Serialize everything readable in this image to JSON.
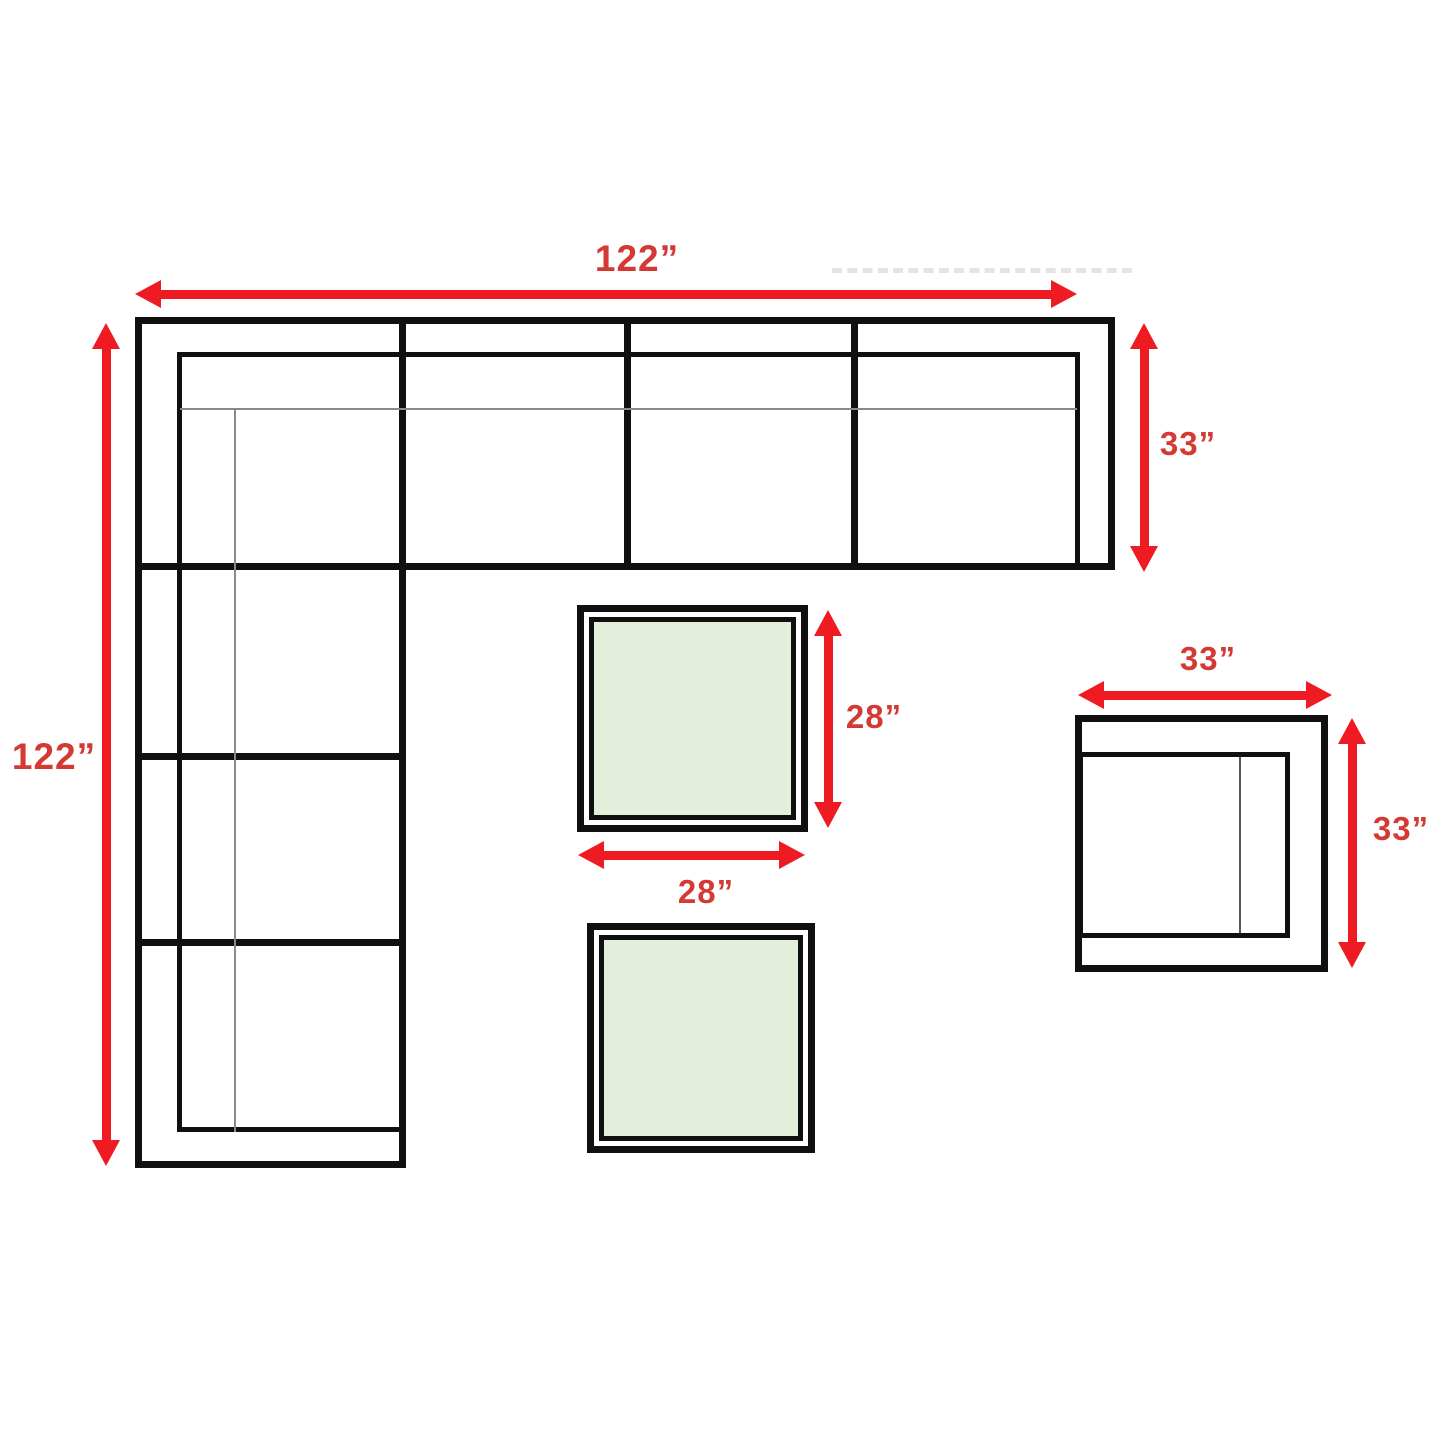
{
  "diagram": {
    "type": "furniture-dimension-diagram",
    "colors": {
      "arrow_red": "#ee1b22",
      "label_red": "#d43a33",
      "line_black": "#101010",
      "line_gray": "#8a8a8a",
      "table_green": "#e3efda",
      "background": "#ffffff"
    },
    "sectional_sofa": {
      "width_label": "122”",
      "depth_label": "122”",
      "section_depth_label": "33”",
      "top_row_sections": 4,
      "left_column_sections": 4
    },
    "coffee_table": {
      "depth_label": "28”",
      "width_label": "28”",
      "count": 2
    },
    "armchair": {
      "width_label": "33”",
      "depth_label": "33”"
    }
  }
}
